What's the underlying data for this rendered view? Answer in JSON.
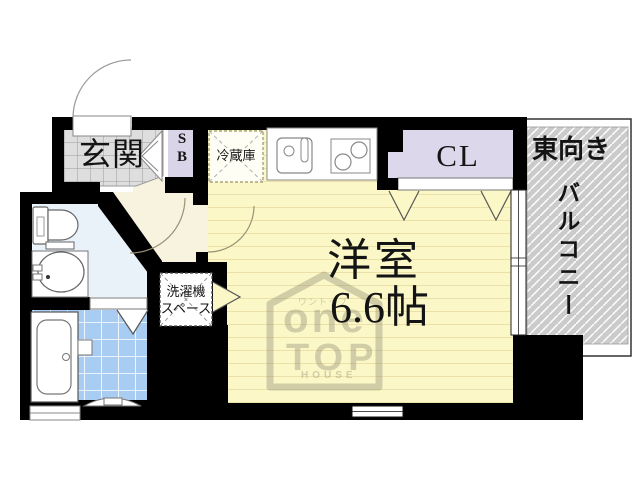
{
  "rooms": {
    "genkan": {
      "label": "玄関"
    },
    "shoe_box": {
      "label": "S\nB"
    },
    "refrigerator": {
      "label": "冷蔵庫"
    },
    "closet": {
      "label": "CL"
    },
    "main_room": {
      "name": "洋室",
      "size": "6.6帖"
    },
    "washer_space": {
      "label": "洗濯機\nスペース"
    },
    "balcony": {
      "direction": "東向き",
      "label": "バルコニー"
    }
  },
  "watermark": {
    "kana": "ワントップ",
    "word1": "one",
    "word2": "TOP",
    "word3": "HOUSE"
  },
  "colors": {
    "wall": "#000000",
    "floor": "#FBF7C7",
    "floor_line": "#EBE0A8",
    "hall": "#F8F3DE",
    "genkan": "#DEDEDE",
    "closet_fill": "#DCD7EA",
    "toilet_room": "#E9F1F9",
    "bath_tile": "#A9CDF2",
    "balcony_fill": "#CBCBCB",
    "watermark": "#8F8A74"
  }
}
